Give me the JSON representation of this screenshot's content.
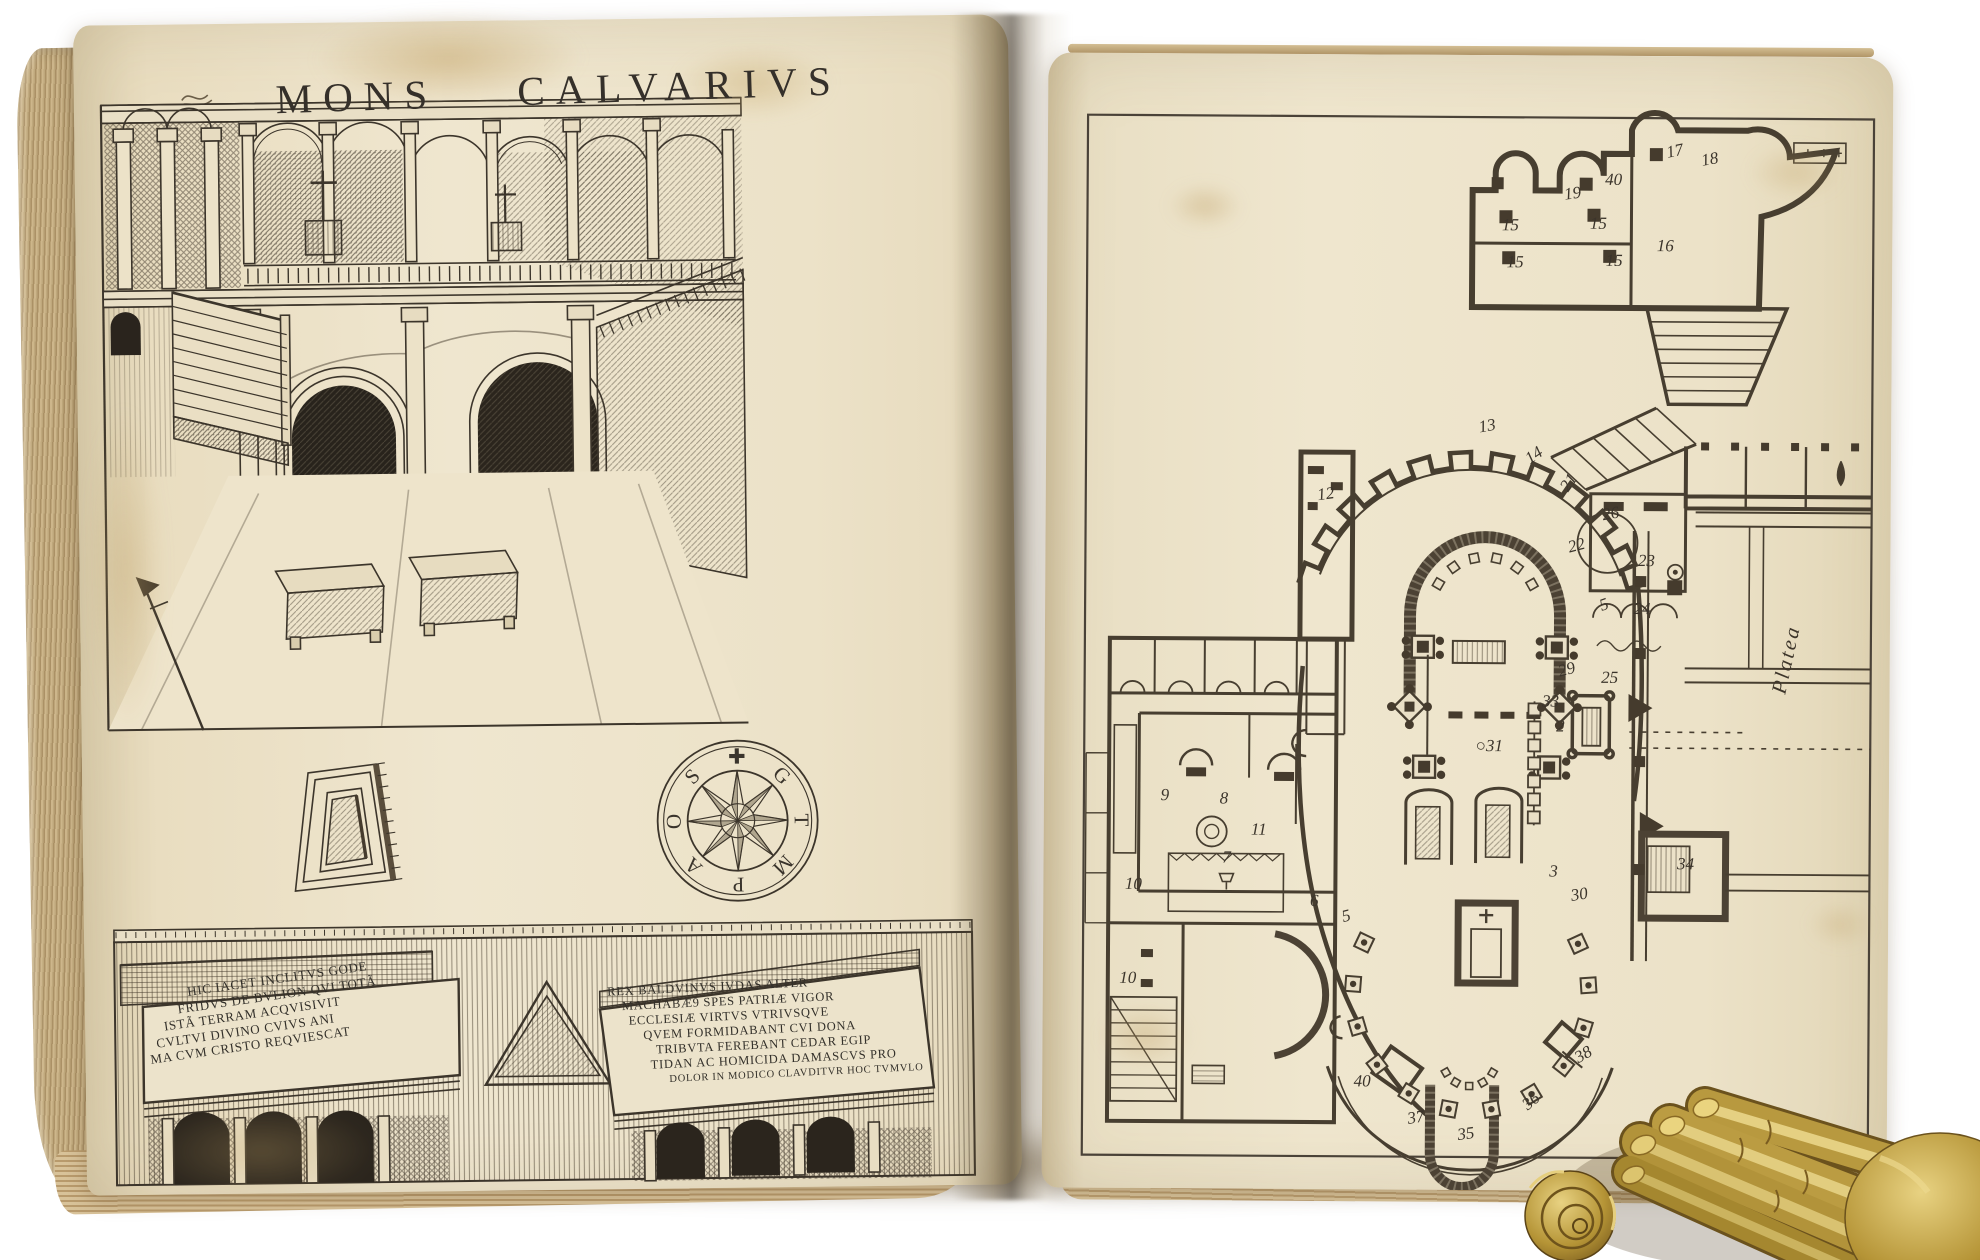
{
  "photo": {
    "background": "#ffffff",
    "paper": "#ece3cb",
    "ink": "#35302a",
    "page_edge": "#c9b189",
    "brass": "#c2a24e"
  },
  "book": {
    "left_page": {
      "title": "MONS CALVARIVS",
      "compass": {
        "letters": [
          "✚",
          "G",
          "T",
          "M",
          "P",
          "A",
          "O",
          "S"
        ]
      },
      "tomb_inscription_godfrey": {
        "lines": [
          "HIC IACET INCLITVS GODE",
          "FRIDVS DE BVLION QVI TOTÃ",
          "ISTÃ TERRAM ACQVISIVIT",
          "CVLTVI DIVINO CVIVS ANI",
          "MA CVM CRISTO REQVIESCAT"
        ]
      },
      "tomb_inscription_baldwin": {
        "lines": [
          "REX BALDVINVS IVDAS ALTER",
          "MACHABÆ9 SPES PATRIÆ VIGOR",
          "ECCLESIÆ VIRTVS VTRIVSQVE",
          "QVEM FORMIDABANT CVI DONA",
          "TRIBVTA FEREBANT CEDAR EGIP",
          "TIDAN AC HOMICIDA DAMASCVS PRO",
          "DOLOR IN MODICO CLAVDITVR HOC TVMVLO"
        ]
      }
    },
    "right_page": {
      "platea_label": "Platea",
      "plan_numbers": [
        {
          "n": "17",
          "x": 627,
          "y": 95,
          "r": -12
        },
        {
          "n": "18",
          "x": 662,
          "y": 103,
          "r": -10
        },
        {
          "n": "40",
          "x": 566,
          "y": 124,
          "r": 0
        },
        {
          "n": "19",
          "x": 525,
          "y": 138,
          "r": -8
        },
        {
          "n": "15",
          "x": 463,
          "y": 170,
          "r": 0
        },
        {
          "n": "15",
          "x": 551,
          "y": 168,
          "r": 0
        },
        {
          "n": "16",
          "x": 618,
          "y": 190,
          "r": 0
        },
        {
          "n": "15",
          "x": 468,
          "y": 207,
          "r": 0
        },
        {
          "n": "15",
          "x": 567,
          "y": 205,
          "r": 0
        },
        {
          "n": "13",
          "x": 441,
          "y": 371,
          "r": -10
        },
        {
          "n": "14",
          "x": 488,
          "y": 400,
          "r": -35
        },
        {
          "n": "21",
          "x": 523,
          "y": 427,
          "r": -55
        },
        {
          "n": "12",
          "x": 280,
          "y": 440,
          "r": -8
        },
        {
          "n": "26",
          "x": 565,
          "y": 458,
          "r": -10
        },
        {
          "n": "22",
          "x": 531,
          "y": 490,
          "r": -15
        },
        {
          "n": "23",
          "x": 601,
          "y": 505,
          "r": 0
        },
        {
          "n": "5",
          "x": 559,
          "y": 549,
          "r": -20
        },
        {
          "n": "24",
          "x": 597,
          "y": 553,
          "r": 0
        },
        {
          "n": "29",
          "x": 522,
          "y": 614,
          "r": -15
        },
        {
          "n": "25",
          "x": 565,
          "y": 622,
          "r": 0
        },
        {
          "n": "33",
          "x": 506,
          "y": 646,
          "r": 0
        },
        {
          "n": "2",
          "x": 516,
          "y": 671,
          "r": 0
        },
        {
          "n": "○31",
          "x": 445,
          "y": 691,
          "r": 0
        },
        {
          "n": "9",
          "x": 121,
          "y": 742,
          "r": 0
        },
        {
          "n": "8",
          "x": 180,
          "y": 745,
          "r": 0
        },
        {
          "n": "11",
          "x": 215,
          "y": 776,
          "r": 0
        },
        {
          "n": "7",
          "x": 183,
          "y": 804,
          "r": 0
        },
        {
          "n": "10",
          "x": 90,
          "y": 831,
          "r": 0
        },
        {
          "n": "6",
          "x": 271,
          "y": 847,
          "r": 0
        },
        {
          "n": "5",
          "x": 303,
          "y": 862,
          "r": -15
        },
        {
          "n": "3",
          "x": 510,
          "y": 816,
          "r": 0
        },
        {
          "n": "30",
          "x": 536,
          "y": 839,
          "r": -10
        },
        {
          "n": "34",
          "x": 642,
          "y": 808,
          "r": 0
        },
        {
          "n": "10",
          "x": 85,
          "y": 925,
          "r": 0
        },
        {
          "n": "40",
          "x": 320,
          "y": 1027,
          "r": 0
        },
        {
          "n": "37",
          "x": 374,
          "y": 1063,
          "r": -10
        },
        {
          "n": "35",
          "x": 424,
          "y": 1079,
          "r": -8
        },
        {
          "n": "36",
          "x": 489,
          "y": 1046,
          "r": -40
        },
        {
          "n": "38",
          "x": 541,
          "y": 999,
          "r": -30
        }
      ]
    }
  }
}
